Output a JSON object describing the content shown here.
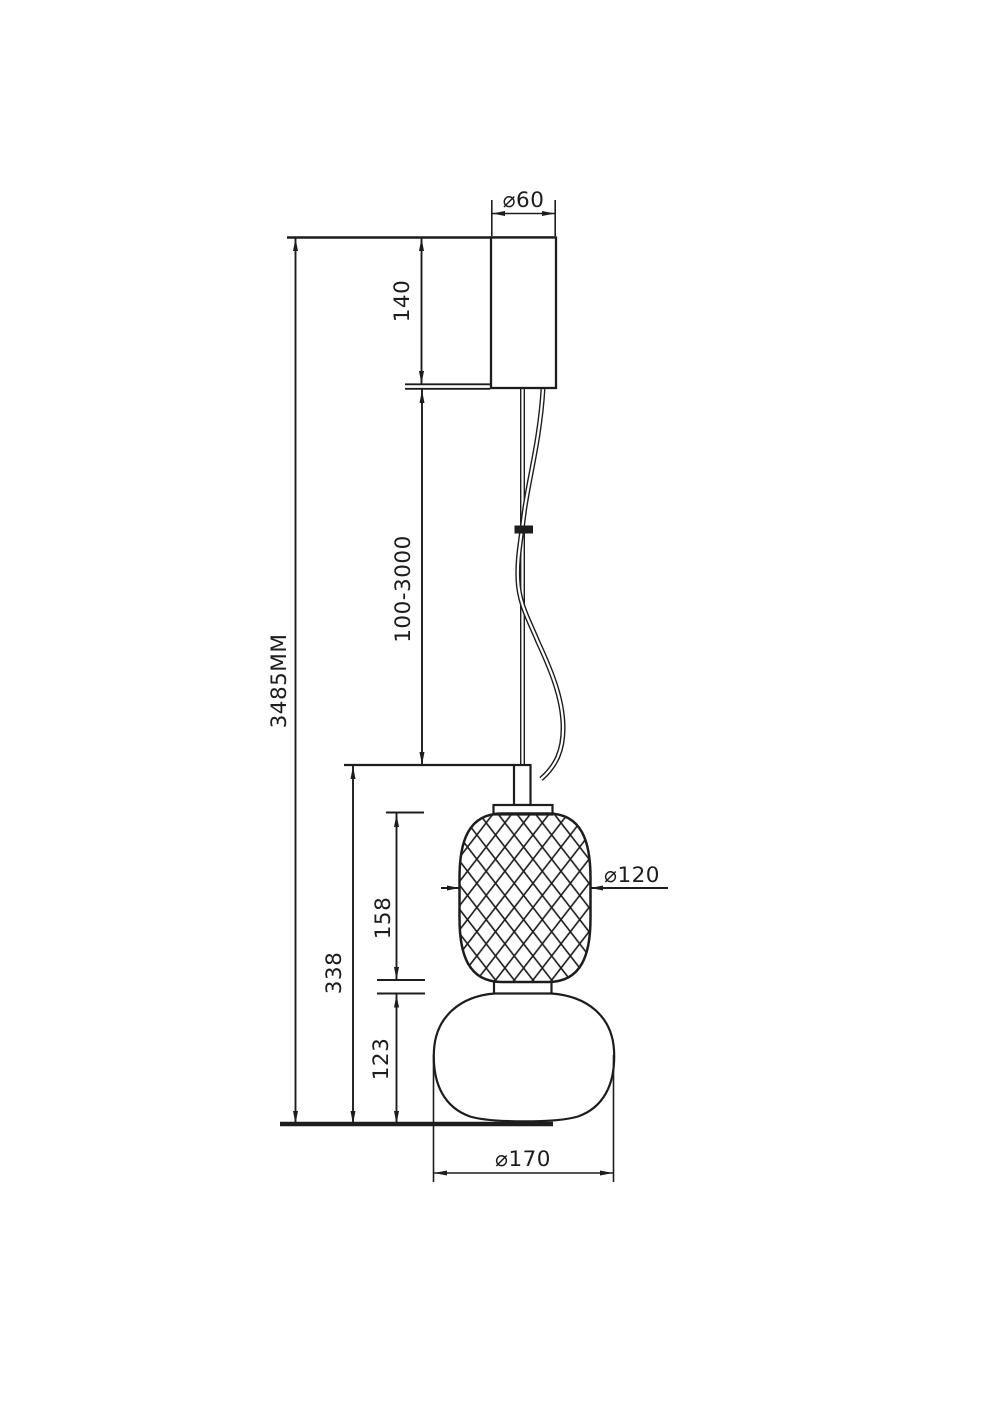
{
  "colors": {
    "line": "#1d1d1d",
    "background": "#ffffff"
  },
  "dimensions": {
    "canopy_diameter": "⌀60",
    "canopy_height": "140",
    "suspension_length": "100-3000",
    "total_height": "3485MM",
    "body_height": "338",
    "mesh_shade_height": "158",
    "glass_shade_height": "123",
    "mesh_shade_diameter": "⌀120",
    "glass_shade_diameter": "⌀170"
  }
}
